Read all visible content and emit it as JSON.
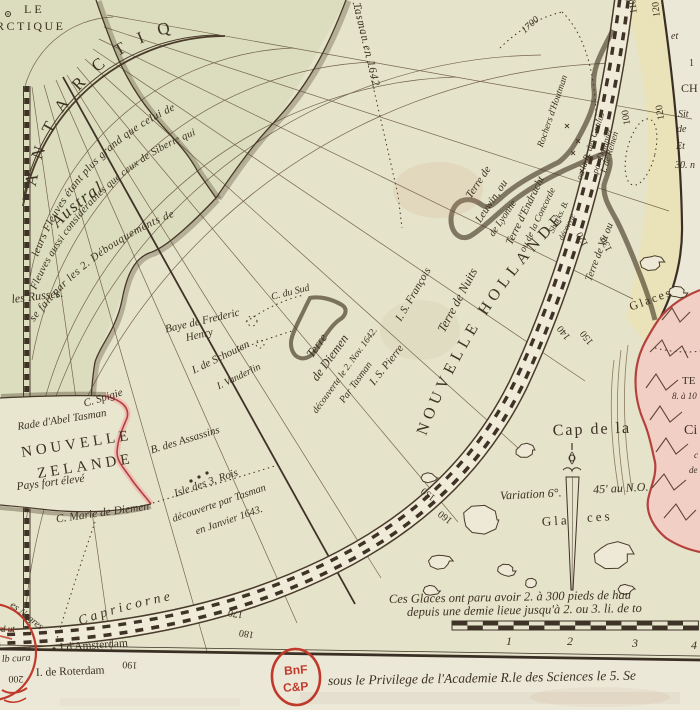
{
  "map": {
    "type": "antique-polar-map",
    "region": "Hémisphère méridional / Terres Australes",
    "stamp": {
      "line1": "BnF",
      "line2": "C&P"
    },
    "bottom": {
      "glaces_note_1": "Ces Glaces ont paru avoir 2. à 300 pieds de hau",
      "glaces_note_2": "depuis une demie lieue jusqu'à 2. ou 3. li. de to",
      "privilege": "sous le Privilege de l'Academie R.le des Sciences le 5. Se",
      "scale_numbers": [
        "1",
        "2",
        "3",
        "4"
      ]
    },
    "palette": {
      "paper": "#e9e5d0",
      "disc": "#e3e1c8",
      "austral_land": "#d9dcbc",
      "band_zone": "#ebe3b6",
      "ink": "#3c3122",
      "coast_yellow": "#e8d24a",
      "coast_pink": "#b5413c",
      "pink_wash": "#f2cfc5",
      "stamp_red": "#c0392b"
    }
  },
  "curved": [
    {
      "n": "label-antarctique-arc",
      "p": "arcLetters",
      "t": "ANTARCTIQ",
      "s": 17,
      "st": "r",
      "sp": 15
    },
    {
      "n": "label-austral",
      "p": "arcAustral",
      "t": "Austral",
      "s": 17,
      "st": "i",
      "sp": 1.5
    },
    {
      "n": "note-fleuves-1",
      "p": "arcL1",
      "t": "leurs Fleuves étant plus grand que celui de",
      "s": 11,
      "st": "i",
      "sp": 0.4
    },
    {
      "n": "note-fleuves-2",
      "p": "arcL2",
      "t": "Fleuves aussi considérables que ceux de Siberie qui",
      "s": 10.5,
      "st": "i",
      "sp": 0.2
    },
    {
      "n": "note-fleuves-3",
      "p": "arcL3",
      "t": "se fait par les 2. Débouquements de",
      "s": 11,
      "st": "i",
      "sp": 0.6
    },
    {
      "n": "label-nouvelle-hollande",
      "p": "arcHollande",
      "t": "NOUVELLE HOLLANDE",
      "s": 16,
      "st": "r",
      "sp": 5
    },
    {
      "n": "label-capricorne",
      "p": "arcCapricorne",
      "t": "Capricorne",
      "s": 13.5,
      "st": "i",
      "sp": 3.5
    },
    {
      "n": "label-tasman-track",
      "p": "tasmanPath",
      "t": "Tasman en 1642.",
      "s": 11,
      "st": "i",
      "sp": 1,
      "off": 6
    }
  ],
  "labels": [
    {
      "n": "label-cercle-le",
      "t": "LE",
      "x": 24,
      "y": 13,
      "r": 0,
      "s": 12,
      "st": "r",
      "sp": 3,
      "a": "start"
    },
    {
      "n": "label-cercle-rctique",
      "t": "RCTIQUE",
      "x": -4,
      "y": 30,
      "r": 0,
      "s": 12,
      "st": "r",
      "sp": 2.5,
      "a": "start"
    },
    {
      "n": "note-les-russes",
      "t": "les Russes.",
      "x": 12,
      "y": 303,
      "r": -7,
      "s": 12,
      "st": "i",
      "a": "start"
    },
    {
      "n": "label-baye-frederic",
      "t": "Baye de Frederic",
      "x": 203,
      "y": 324,
      "r": -13,
      "s": 11,
      "st": "i"
    },
    {
      "n": "label-henry",
      "t": "Henry",
      "x": 200,
      "y": 338,
      "r": -13,
      "s": 11,
      "st": "i"
    },
    {
      "n": "label-c-du-sud",
      "t": "C. du Sud",
      "x": 291,
      "y": 295,
      "r": -14,
      "s": 10,
      "st": "i"
    },
    {
      "n": "label-i-schouten",
      "t": "I. de Schouten",
      "x": 222,
      "y": 360,
      "r": -26,
      "s": 11,
      "st": "i"
    },
    {
      "n": "label-i-vanderlin",
      "t": "I. Vanderlin",
      "x": 240,
      "y": 379,
      "r": -26,
      "s": 10,
      "st": "i"
    },
    {
      "n": "label-terre-diemen-1",
      "t": "Terre",
      "x": 320,
      "y": 348,
      "r": -54,
      "s": 12.5,
      "st": "i"
    },
    {
      "n": "label-terre-diemen-2",
      "t": "de Diemen",
      "x": 333,
      "y": 360,
      "r": -54,
      "s": 12.5,
      "st": "i"
    },
    {
      "n": "label-terre-diemen-3",
      "t": "découverte le 2. Nov. 1642.",
      "x": 347,
      "y": 372,
      "r": -54,
      "s": 9.5,
      "st": "i"
    },
    {
      "n": "label-terre-diemen-4",
      "t": "Par Tasman",
      "x": 358,
      "y": 384,
      "r": -54,
      "s": 10,
      "st": "i"
    },
    {
      "n": "label-i-s-francois",
      "t": "I. S. François",
      "x": 416,
      "y": 296,
      "r": -60,
      "s": 11,
      "st": "i"
    },
    {
      "n": "label-i-s-pierre",
      "t": "I. S. Pierre",
      "x": 389,
      "y": 367,
      "r": -52,
      "s": 11,
      "st": "i"
    },
    {
      "n": "label-terre-de-nuits",
      "t": "Terre de Nuits",
      "x": 461,
      "y": 302,
      "r": -62,
      "s": 12.5,
      "st": "i"
    },
    {
      "n": "label-leuwin-1",
      "t": "Terre de",
      "x": 481,
      "y": 184,
      "r": -56,
      "s": 11,
      "st": "i"
    },
    {
      "n": "label-leuwin-2",
      "t": "Leuwin, ou",
      "x": 494,
      "y": 203,
      "r": -56,
      "s": 11,
      "st": "i"
    },
    {
      "n": "label-leuwin-3",
      "t": "de Lyonne",
      "x": 505,
      "y": 220,
      "r": -56,
      "s": 10,
      "st": "i"
    },
    {
      "n": "label-endracht-1",
      "t": "Terre d'Endracht",
      "x": 528,
      "y": 212,
      "r": -64,
      "s": 11,
      "st": "i"
    },
    {
      "n": "label-endracht-2",
      "t": "ou de la Concorde",
      "x": 540,
      "y": 221,
      "r": -64,
      "s": 9.5,
      "st": "i"
    },
    {
      "n": "label-sharks-b",
      "t": "Sharks. B.",
      "x": 561,
      "y": 218,
      "r": -64,
      "s": 8.5,
      "st": "i"
    },
    {
      "n": "label-sharks-decouverte",
      "t": "découvte",
      "x": 569,
      "y": 228,
      "r": -64,
      "s": 8,
      "st": "i"
    },
    {
      "n": "label-goulus",
      "t": "ou la B. des Goulus",
      "x": 593,
      "y": 147,
      "r": -71,
      "s": 9,
      "st": "i"
    },
    {
      "n": "label-dampier",
      "t": "par Dampier",
      "x": 605,
      "y": 152,
      "r": -71,
      "s": 9,
      "st": "i"
    },
    {
      "n": "label-houtman",
      "t": "Rochers d'Houtman",
      "x": 555,
      "y": 112,
      "r": -71,
      "s": 9.5,
      "st": "i"
    },
    {
      "n": "label-i-remen",
      "t": "I. de Remen",
      "x": 612,
      "y": 153,
      "r": -73,
      "s": 9,
      "st": "i"
    },
    {
      "n": "label-terre-de-vit",
      "t": "Terre de Vit ou",
      "x": 602,
      "y": 253,
      "r": -69,
      "s": 10.5,
      "st": "i"
    },
    {
      "n": "label-track-1700",
      "t": "1700",
      "x": 532,
      "y": 27,
      "r": -42,
      "s": 10,
      "st": "i"
    },
    {
      "n": "label-c-spigie",
      "t": "C. Spigie",
      "x": 104,
      "y": 401,
      "r": -17,
      "s": 11,
      "st": "i"
    },
    {
      "n": "label-rade-abel-tasman",
      "t": "Rade d'Abel Tasman",
      "x": 18,
      "y": 430,
      "r": -9,
      "s": 11,
      "st": "i",
      "a": "start"
    },
    {
      "n": "label-nouvelle",
      "t": "NOUVELLE",
      "x": 22,
      "y": 457,
      "r": -9,
      "s": 15,
      "st": "r",
      "sp": 4,
      "a": "start"
    },
    {
      "n": "label-zelande",
      "t": "ZELANDE",
      "x": 38,
      "y": 478,
      "r": -9,
      "s": 15,
      "st": "r",
      "sp": 4,
      "a": "start"
    },
    {
      "n": "label-pays-fort-eleve",
      "t": "Pays fort élevé",
      "x": 17,
      "y": 490,
      "r": -7,
      "s": 11.5,
      "st": "i",
      "a": "start"
    },
    {
      "n": "label-b-assassins",
      "t": "B. des Assassins",
      "x": 186,
      "y": 443,
      "r": -17,
      "s": 11,
      "st": "i"
    },
    {
      "n": "label-c-marie-diemen",
      "t": "C. Marie de Diemen",
      "x": 103,
      "y": 516,
      "r": -8,
      "s": 11.5,
      "st": "i"
    },
    {
      "n": "label-3rois-1",
      "t": "Isle des 3. Rois",
      "x": 207,
      "y": 486,
      "r": -19,
      "s": 11,
      "st": "i"
    },
    {
      "n": "label-3rois-2",
      "t": "découverte par Tasman",
      "x": 220,
      "y": 506,
      "r": -19,
      "s": 10.5,
      "st": "i"
    },
    {
      "n": "label-3rois-3",
      "t": "en Janvier 1643.",
      "x": 230,
      "y": 523,
      "r": -19,
      "s": 10.5,
      "st": "i"
    },
    {
      "n": "label-glaces-1",
      "t": "Glaces",
      "x": 652,
      "y": 303,
      "r": -20,
      "s": 12,
      "st": "r",
      "sp": 2
    },
    {
      "n": "label-glaces-2a",
      "t": "Gla",
      "x": 556,
      "y": 525,
      "r": -4,
      "s": 13,
      "st": "r",
      "sp": 3
    },
    {
      "n": "label-glaces-2b",
      "t": "ces",
      "x": 600,
      "y": 521,
      "r": -4,
      "s": 13,
      "st": "r",
      "sp": 3
    },
    {
      "n": "label-variation-a",
      "t": "Variation 6°.",
      "x": 531,
      "y": 498,
      "r": -3,
      "s": 12,
      "st": "i"
    },
    {
      "n": "label-variation-b",
      "t": "45' au N.O.",
      "x": 621,
      "y": 492,
      "r": -3,
      "s": 12,
      "st": "i"
    },
    {
      "n": "label-cap-de-la",
      "t": "Cap de la",
      "x": 592,
      "y": 434,
      "r": -2,
      "s": 16,
      "st": "r",
      "sp": 2
    },
    {
      "n": "label-ci-fragment",
      "t": "Ci",
      "x": 684,
      "y": 434,
      "r": 0,
      "s": 14,
      "st": "r",
      "a": "start"
    },
    {
      "n": "label-te-fragment",
      "t": "TE",
      "x": 682,
      "y": 384,
      "r": 0,
      "s": 11,
      "st": "r",
      "a": "start"
    },
    {
      "n": "label-8a10-fragment",
      "t": "8. à 10",
      "x": 672,
      "y": 399,
      "r": 0,
      "s": 9,
      "st": "i",
      "a": "start"
    },
    {
      "n": "label-c-fragment",
      "t": "c",
      "x": 694,
      "y": 458,
      "r": 0,
      "s": 9,
      "st": "i",
      "a": "start"
    },
    {
      "n": "label-de-fragment",
      "t": "de",
      "x": 689,
      "y": 473,
      "r": 0,
      "s": 9,
      "st": "i",
      "a": "start"
    },
    {
      "n": "edge-et",
      "t": "et",
      "x": 671,
      "y": 39,
      "r": 0,
      "s": 10,
      "st": "i",
      "a": "start"
    },
    {
      "n": "edge-1",
      "t": "1",
      "x": 689,
      "y": 66,
      "r": 0,
      "s": 10,
      "st": "r",
      "a": "start"
    },
    {
      "n": "edge-ch",
      "t": "CH",
      "x": 681,
      "y": 92,
      "r": 0,
      "s": 12,
      "st": "r",
      "a": "start"
    },
    {
      "n": "edge-sit",
      "t": "Sit",
      "x": 678,
      "y": 117,
      "r": 0,
      "s": 10,
      "st": "i",
      "a": "start"
    },
    {
      "n": "edge-de",
      "t": "de",
      "x": 677,
      "y": 132,
      "r": 0,
      "s": 10,
      "st": "i",
      "a": "start"
    },
    {
      "n": "edge-et2",
      "t": "Et",
      "x": 676,
      "y": 149,
      "r": 0,
      "s": 10,
      "st": "i",
      "a": "start"
    },
    {
      "n": "edge-30n",
      "t": "30. n",
      "x": 675,
      "y": 168,
      "r": 0,
      "s": 10,
      "st": "i",
      "a": "start"
    },
    {
      "n": "label-i-amsterdam",
      "t": "I d'Amsterdam",
      "x": 60,
      "y": 651,
      "r": -4,
      "s": 11.5,
      "st": "r",
      "a": "start"
    },
    {
      "n": "label-i-roterdam",
      "t": "I. de Roterdam",
      "x": 36,
      "y": 676,
      "r": -2,
      "s": 11.5,
      "st": "r",
      "a": "start"
    },
    {
      "n": "edge-negres",
      "t": "es Negres",
      "x": 25,
      "y": 618,
      "r": 38,
      "s": 10,
      "st": "i"
    },
    {
      "n": "edge-d-ut",
      "t": "d ut",
      "x": 1,
      "y": 632,
      "r": 0,
      "s": 9,
      "st": "i",
      "a": "start"
    },
    {
      "n": "edge-b-cura",
      "t": "lb cura",
      "x": 2,
      "y": 662,
      "r": -3,
      "s": 10,
      "st": "i",
      "a": "start"
    },
    {
      "n": "note-glaces-1",
      "t": "Ces Glaces ont paru avoir 2. à 300 pieds de hau",
      "x": 389,
      "y": 603,
      "r": -1,
      "s": 12.5,
      "st": "i",
      "a": "start"
    },
    {
      "n": "note-glaces-2",
      "t": "depuis une demie lieue jusqu'à 2. ou 3. li. de to",
      "x": 407,
      "y": 616,
      "r": -1,
      "s": 12.5,
      "st": "i",
      "a": "start"
    },
    {
      "n": "note-privilege",
      "t": "sous le Privilege de l'Academie R.le des Sciences le 5. Se",
      "x": 328,
      "y": 685,
      "r": -1,
      "s": 13.5,
      "st": "i",
      "a": "start"
    },
    {
      "n": "scale-num-1",
      "t": "1",
      "x": 509,
      "y": 645,
      "r": 0,
      "s": 12,
      "st": "i"
    },
    {
      "n": "scale-num-2",
      "t": "2",
      "x": 570,
      "y": 645,
      "r": 0,
      "s": 12,
      "st": "i"
    },
    {
      "n": "scale-num-3",
      "t": "3",
      "x": 635,
      "y": 647,
      "r": 0,
      "s": 12,
      "st": "i"
    },
    {
      "n": "scale-num-4",
      "t": "4",
      "x": 694,
      "y": 649,
      "r": 0,
      "s": 12,
      "st": "i"
    },
    {
      "n": "longitude-110",
      "t": "110",
      "x": 636,
      "y": 6,
      "r": 263,
      "s": 10,
      "st": "r"
    },
    {
      "n": "longitude-120a",
      "t": "120",
      "x": 659,
      "y": 9,
      "r": 263,
      "s": 10,
      "st": "r"
    },
    {
      "n": "longitude-100",
      "t": "100",
      "x": 629,
      "y": 117,
      "r": 260,
      "s": 10,
      "st": "r"
    },
    {
      "n": "longitude-120b",
      "t": "120",
      "x": 663,
      "y": 112,
      "r": 260,
      "s": 10,
      "st": "r"
    },
    {
      "n": "longitude-120c",
      "t": "120",
      "x": 585,
      "y": 238,
      "r": 243,
      "s": 10,
      "st": "r"
    },
    {
      "n": "longitude-130",
      "t": "130",
      "x": 609,
      "y": 243,
      "r": 243,
      "s": 10,
      "st": "r"
    },
    {
      "n": "longitude-140",
      "t": "140",
      "x": 566,
      "y": 331,
      "r": 232,
      "s": 10,
      "st": "r"
    },
    {
      "n": "longitude-150a",
      "t": "150",
      "x": 589,
      "y": 336,
      "r": 232,
      "s": 10,
      "st": "r"
    },
    {
      "n": "longitude-150b",
      "t": "150",
      "x": 430,
      "y": 492,
      "r": 218,
      "s": 10,
      "st": "r"
    },
    {
      "n": "longitude-160",
      "t": "160",
      "x": 447,
      "y": 515,
      "r": 218,
      "s": 10,
      "st": "r"
    },
    {
      "n": "longitude-170",
      "t": "170",
      "x": 236,
      "y": 611,
      "r": 190,
      "s": 10,
      "st": "r"
    },
    {
      "n": "longitude-180",
      "t": "180",
      "x": 247,
      "y": 631,
      "r": 190,
      "s": 10,
      "st": "r"
    },
    {
      "n": "longitude-190",
      "t": "190",
      "x": 130,
      "y": 662,
      "r": 183,
      "s": 10,
      "st": "r"
    },
    {
      "n": "longitude-200",
      "t": "200",
      "x": 16,
      "y": 676,
      "r": 181,
      "s": 10,
      "st": "r"
    }
  ],
  "stamp_labels": [
    {
      "n": "bnf-stamp-line1",
      "t": "BnF",
      "x": 296,
      "y": 674,
      "s": 12
    },
    {
      "n": "bnf-stamp-line2",
      "t": "C&P",
      "x": 296,
      "y": 691,
      "s": 12
    }
  ]
}
